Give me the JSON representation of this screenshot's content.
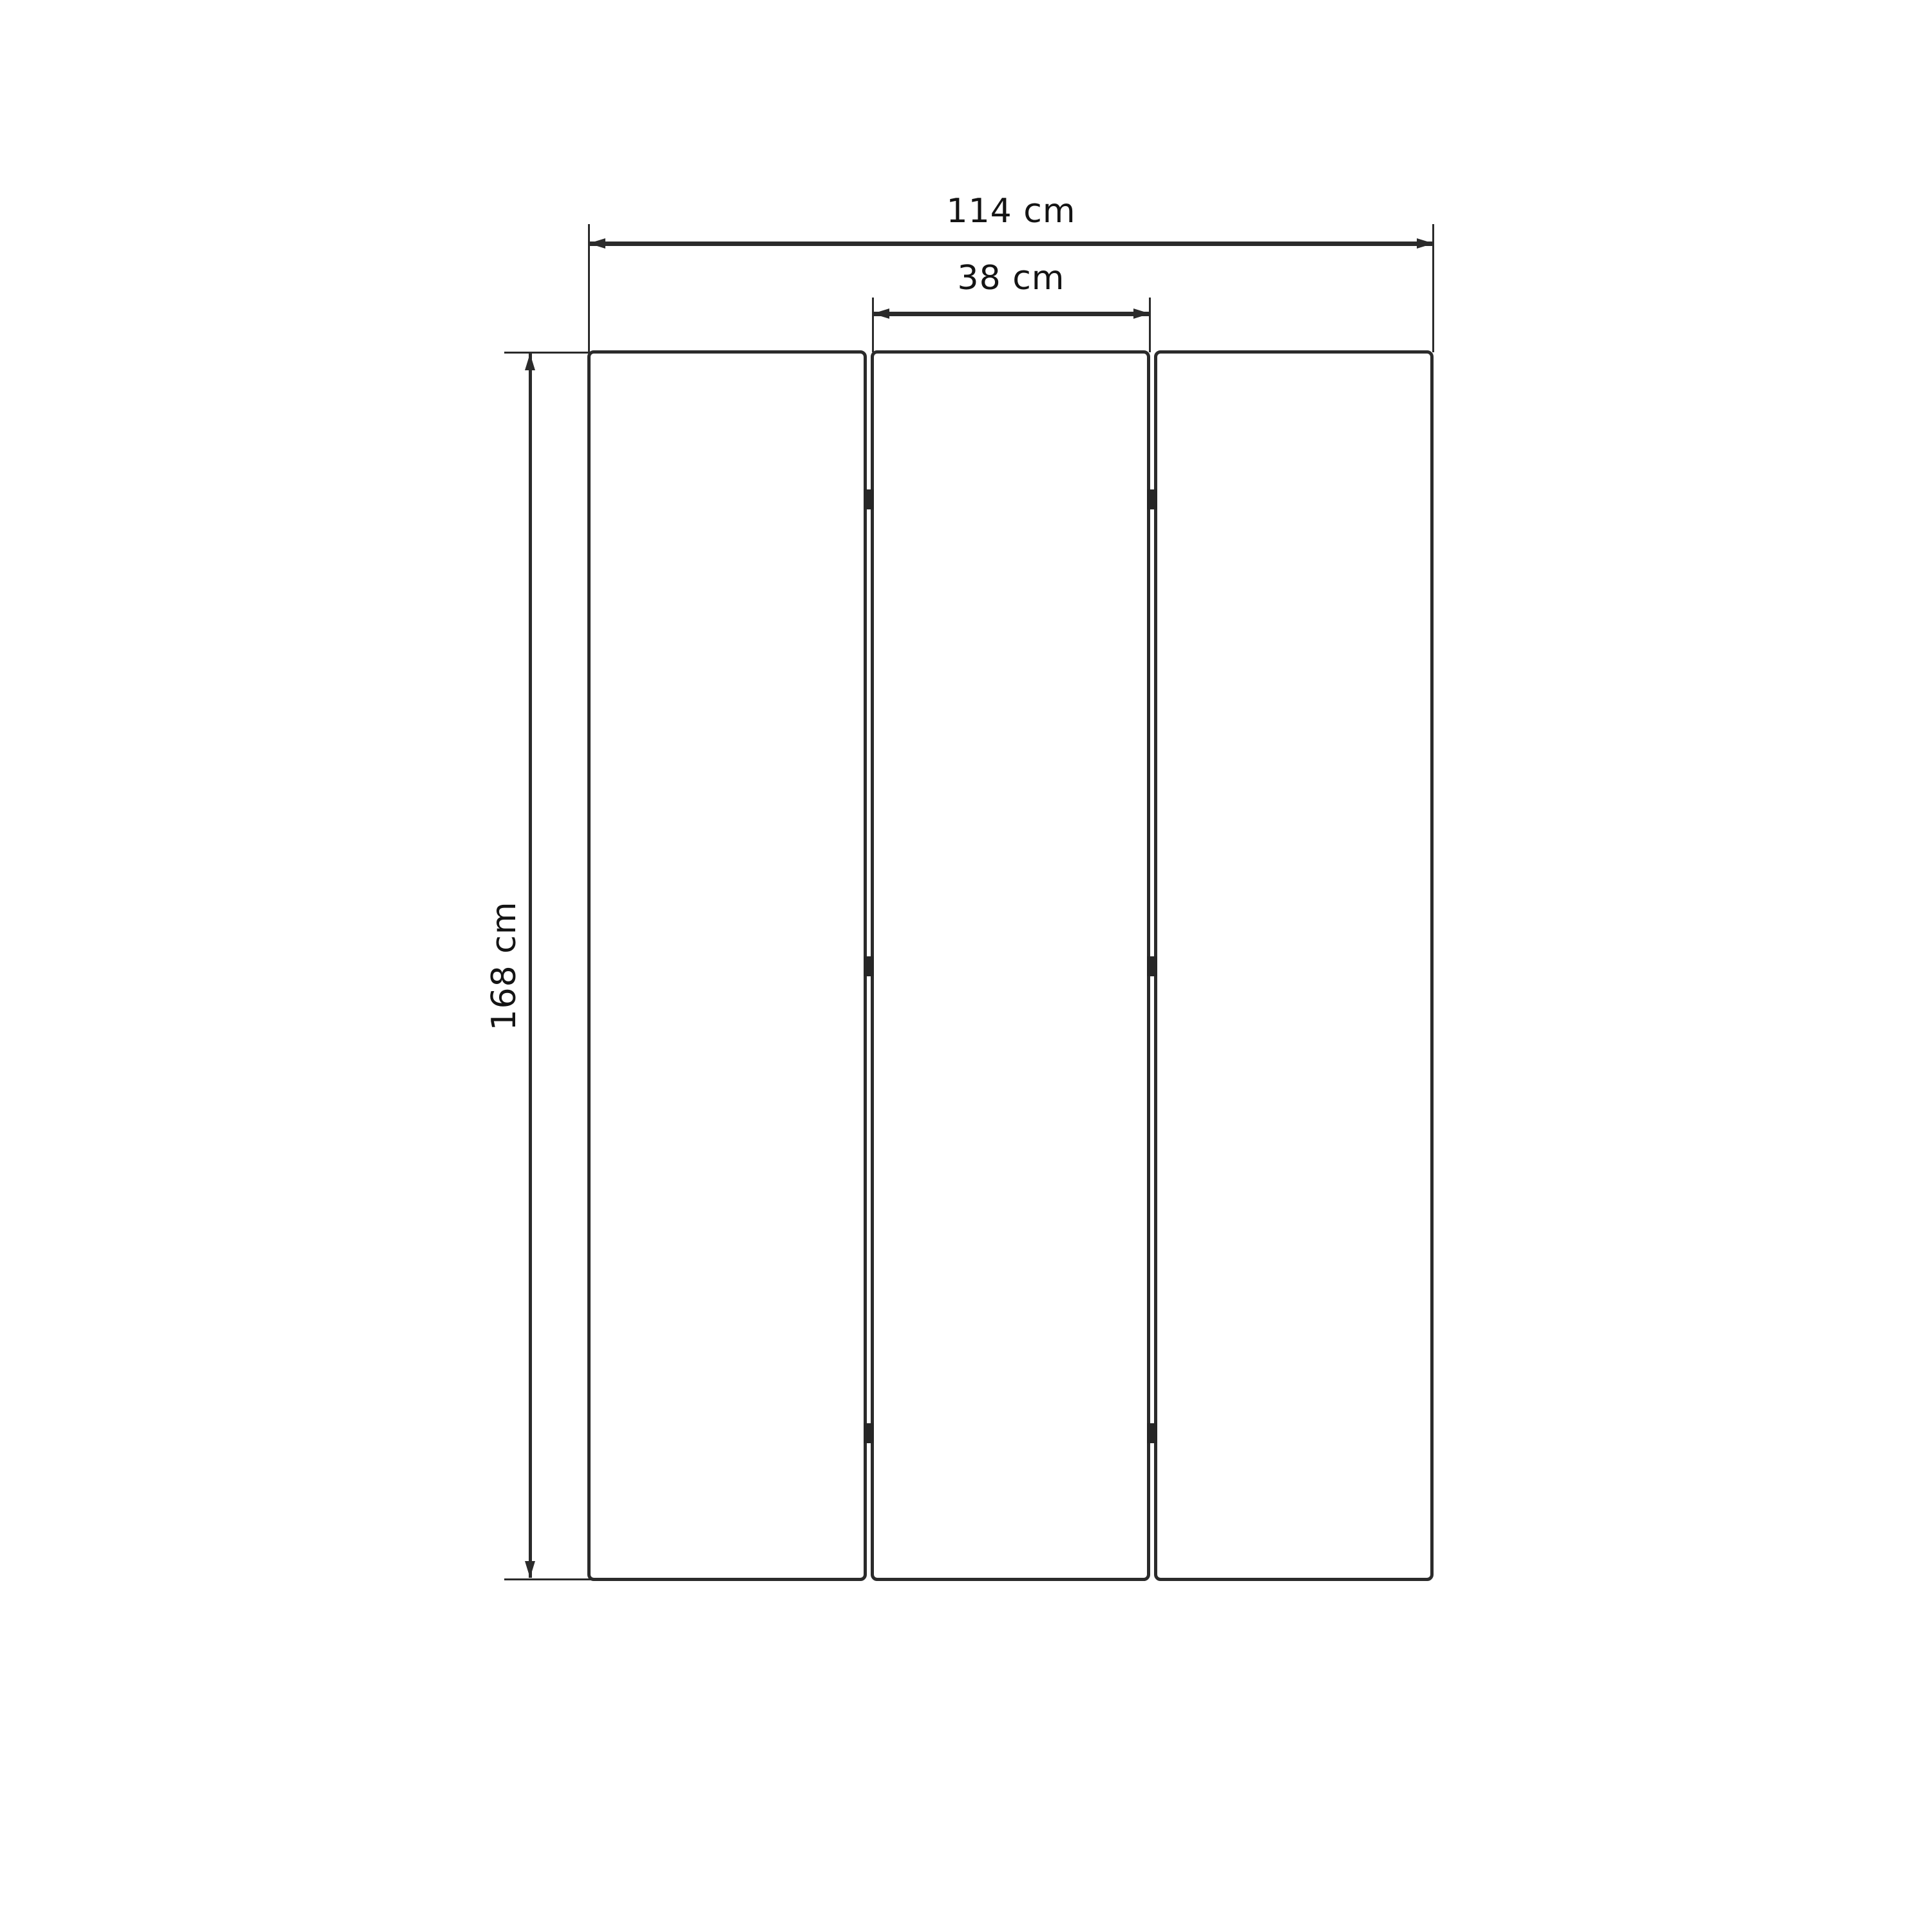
{
  "diagram": {
    "type": "furniture-dimension-drawing",
    "subject": "three-panel folding screen, front view",
    "panel_count": 3,
    "hinge_rows": 3,
    "dimensions": {
      "total_width": {
        "value": 114,
        "unit": "cm",
        "label": "114 cm"
      },
      "panel_width": {
        "value": 38,
        "unit": "cm",
        "label": "38 cm"
      },
      "height": {
        "value": 168,
        "unit": "cm",
        "label": "168 cm"
      }
    },
    "colors": {
      "line": "#2b2b2b",
      "text": "#141414",
      "panel_fill": "#ffffff",
      "hinge": "#262626",
      "background": "#ffffff"
    }
  }
}
